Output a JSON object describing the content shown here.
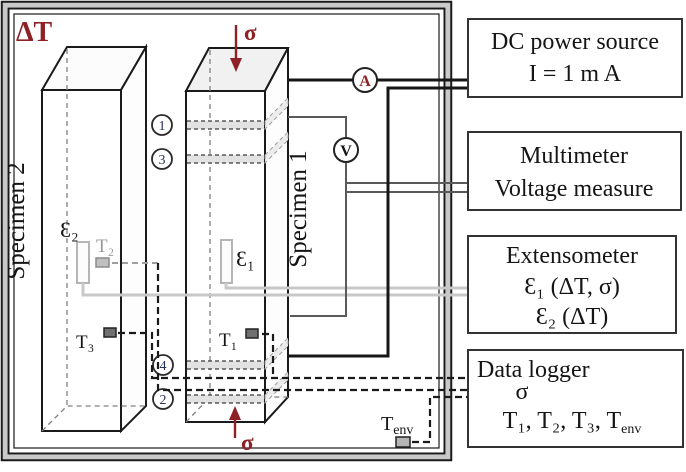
{
  "chamber": {
    "label": "ΔT"
  },
  "stress_symbol": "σ",
  "specimen1": {
    "label": "Specimen 1",
    "extensometer": "Ɛ₁",
    "thermocouple": "T₁",
    "probe_points": {
      "p1": "1",
      "p3": "3",
      "p4": "4",
      "p2": "2"
    }
  },
  "specimen2": {
    "label": "Specimen 2",
    "extensometer": "Ɛ₂",
    "thermocouple_t2": "T₂",
    "thermocouple_t3": "T₃"
  },
  "meters": {
    "ammeter": "A",
    "voltmeter": "V"
  },
  "t_env": {
    "base": "T",
    "sub": "env"
  },
  "instruments": {
    "dc_power_source": {
      "line1": "DC power source",
      "line2": "I = 1 m A"
    },
    "multimeter": {
      "line1": "Multimeter",
      "line2": "Voltage measure"
    },
    "extensometer": {
      "line1": "Extensometer",
      "line2": "Ɛ₁ (ΔT, σ)",
      "line3": "Ɛ₂ (ΔT)"
    },
    "data_logger": {
      "line1": "Data logger",
      "line2": "σ",
      "line3_base": "T₁, T₂, T₃, T",
      "line3_sub": "env"
    }
  },
  "colors": {
    "accent_red": "#8e2126",
    "wire_black": "#161616",
    "wire_gray": "#5a5a5a",
    "wire_light_gray": "#c8c8c8",
    "frame_gray": "#c9c9c9"
  }
}
